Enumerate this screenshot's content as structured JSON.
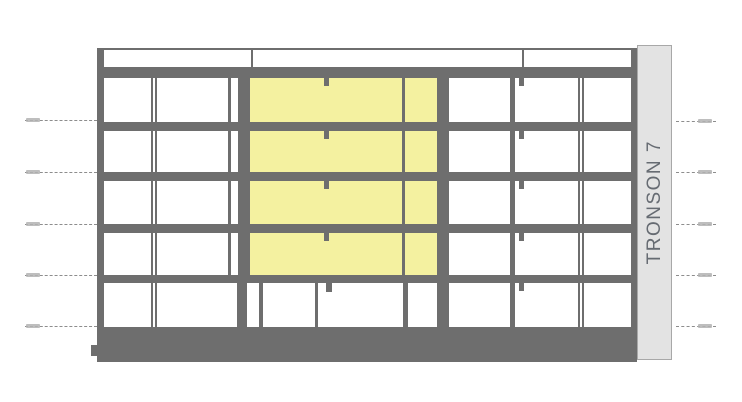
{
  "meta": {
    "drawing_type": "building-section-elevation"
  },
  "band": {
    "label": "TRONSON 7"
  },
  "colors": {
    "structure": "#6e6e6e",
    "highlight": "#f4f1a0",
    "room": "#ffffff",
    "band_fill": "#e3e3e3",
    "band_border": "#a8a8a8",
    "band_text": "#666b72",
    "level_line": "#8d8d8d",
    "level_label": "#b3b3b3",
    "background": "#ffffff"
  },
  "figure": {
    "canvas": {
      "w": 742,
      "h": 402
    },
    "structure_rects": [
      {
        "x": 97,
        "y": 48,
        "w": 540,
        "h": 314,
        "name": "building-structure"
      },
      {
        "x": 91,
        "y": 345,
        "w": 6,
        "h": 11,
        "name": "base-step"
      }
    ],
    "parapet": {
      "y": 50,
      "h": 17,
      "cells": [
        {
          "x": 104,
          "w": 147
        },
        {
          "x": 253,
          "w": 269
        },
        {
          "x": 524,
          "w": 107
        }
      ]
    },
    "rows": [
      {
        "y": 78,
        "h": 44,
        "cells": "typical"
      },
      {
        "y": 131,
        "h": 41,
        "cells": "typical"
      },
      {
        "y": 181,
        "h": 43,
        "cells": "typical"
      },
      {
        "y": 233,
        "h": 42,
        "cells": "typical"
      },
      {
        "y": 283,
        "h": 44,
        "cells": "ground"
      }
    ],
    "cell_sets": {
      "typical": [
        {
          "x": 104,
          "w": 47,
          "k": "room"
        },
        {
          "x": 153,
          "w": 2,
          "k": "room"
        },
        {
          "x": 157,
          "w": 71,
          "k": "room"
        },
        {
          "x": 231,
          "w": 7,
          "k": "room"
        },
        {
          "x": 250,
          "w": 152,
          "k": "highlight"
        },
        {
          "x": 405,
          "w": 32,
          "k": "highlight"
        },
        {
          "x": 449,
          "w": 61,
          "k": "room"
        },
        {
          "x": 515,
          "w": 63,
          "k": "room"
        },
        {
          "x": 580,
          "w": 2,
          "k": "room"
        },
        {
          "x": 584,
          "w": 47,
          "k": "room"
        }
      ],
      "ground": [
        {
          "x": 104,
          "w": 47,
          "k": "room"
        },
        {
          "x": 153,
          "w": 2,
          "k": "room"
        },
        {
          "x": 157,
          "w": 80,
          "k": "room"
        },
        {
          "x": 247,
          "w": 12,
          "k": "room"
        },
        {
          "x": 263,
          "w": 52,
          "k": "room"
        },
        {
          "x": 318,
          "w": 8,
          "k": "room"
        },
        {
          "x": 326,
          "w": 77,
          "k": "room"
        },
        {
          "x": 408,
          "w": 29,
          "k": "room"
        },
        {
          "x": 449,
          "w": 61,
          "k": "room"
        },
        {
          "x": 515,
          "w": 63,
          "k": "room"
        },
        {
          "x": 580,
          "w": 2,
          "k": "room"
        },
        {
          "x": 584,
          "w": 47,
          "k": "room"
        }
      ]
    },
    "notches": [
      {
        "x": 324,
        "y": 78,
        "w": 5,
        "h": 8
      },
      {
        "x": 519,
        "y": 78,
        "w": 5,
        "h": 8
      },
      {
        "x": 324,
        "y": 131,
        "w": 5,
        "h": 8
      },
      {
        "x": 519,
        "y": 131,
        "w": 5,
        "h": 8
      },
      {
        "x": 324,
        "y": 181,
        "w": 5,
        "h": 8
      },
      {
        "x": 519,
        "y": 181,
        "w": 5,
        "h": 8
      },
      {
        "x": 324,
        "y": 233,
        "w": 5,
        "h": 8
      },
      {
        "x": 519,
        "y": 233,
        "w": 5,
        "h": 8
      },
      {
        "x": 326,
        "y": 283,
        "w": 6,
        "h": 9
      },
      {
        "x": 519,
        "y": 283,
        "w": 5,
        "h": 8
      }
    ],
    "levels": {
      "left": {
        "x1": 25,
        "x2": 97,
        "label_x": 26,
        "label_w": 14,
        "ys": [
          120,
          172,
          224,
          275,
          326
        ]
      },
      "right": {
        "x1": 676,
        "x2": 716,
        "label_x": 698,
        "label_w": 14,
        "ys": [
          121,
          172,
          224,
          275,
          326
        ]
      }
    },
    "band_rect": {
      "x": 637,
      "y": 45,
      "w": 35,
      "h": 315
    }
  }
}
